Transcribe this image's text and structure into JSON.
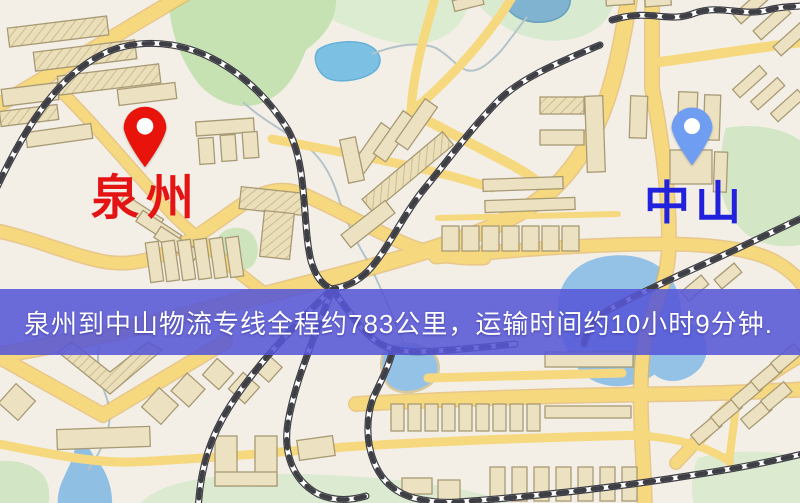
{
  "banner": {
    "text": "泉州到中山物流专线全程约783公里，运输时间约10小时9分钟.",
    "background": "#5656d7",
    "text_color": "#ffffff"
  },
  "origin_marker": {
    "label": "泉州",
    "pin_color": "#e8140c",
    "label_color": "#e41414"
  },
  "destination_marker": {
    "label": "中山",
    "pin_color": "#6f9df2",
    "label_color": "#2222dc"
  },
  "map_colors": {
    "background": "#f3efe7",
    "road_fill": "#f6d87f",
    "road_casing": "#e2b35b",
    "water": "#93c2e6",
    "park": "#cde4bc",
    "building": "#ece2c2",
    "railway": "#3e3e45"
  }
}
